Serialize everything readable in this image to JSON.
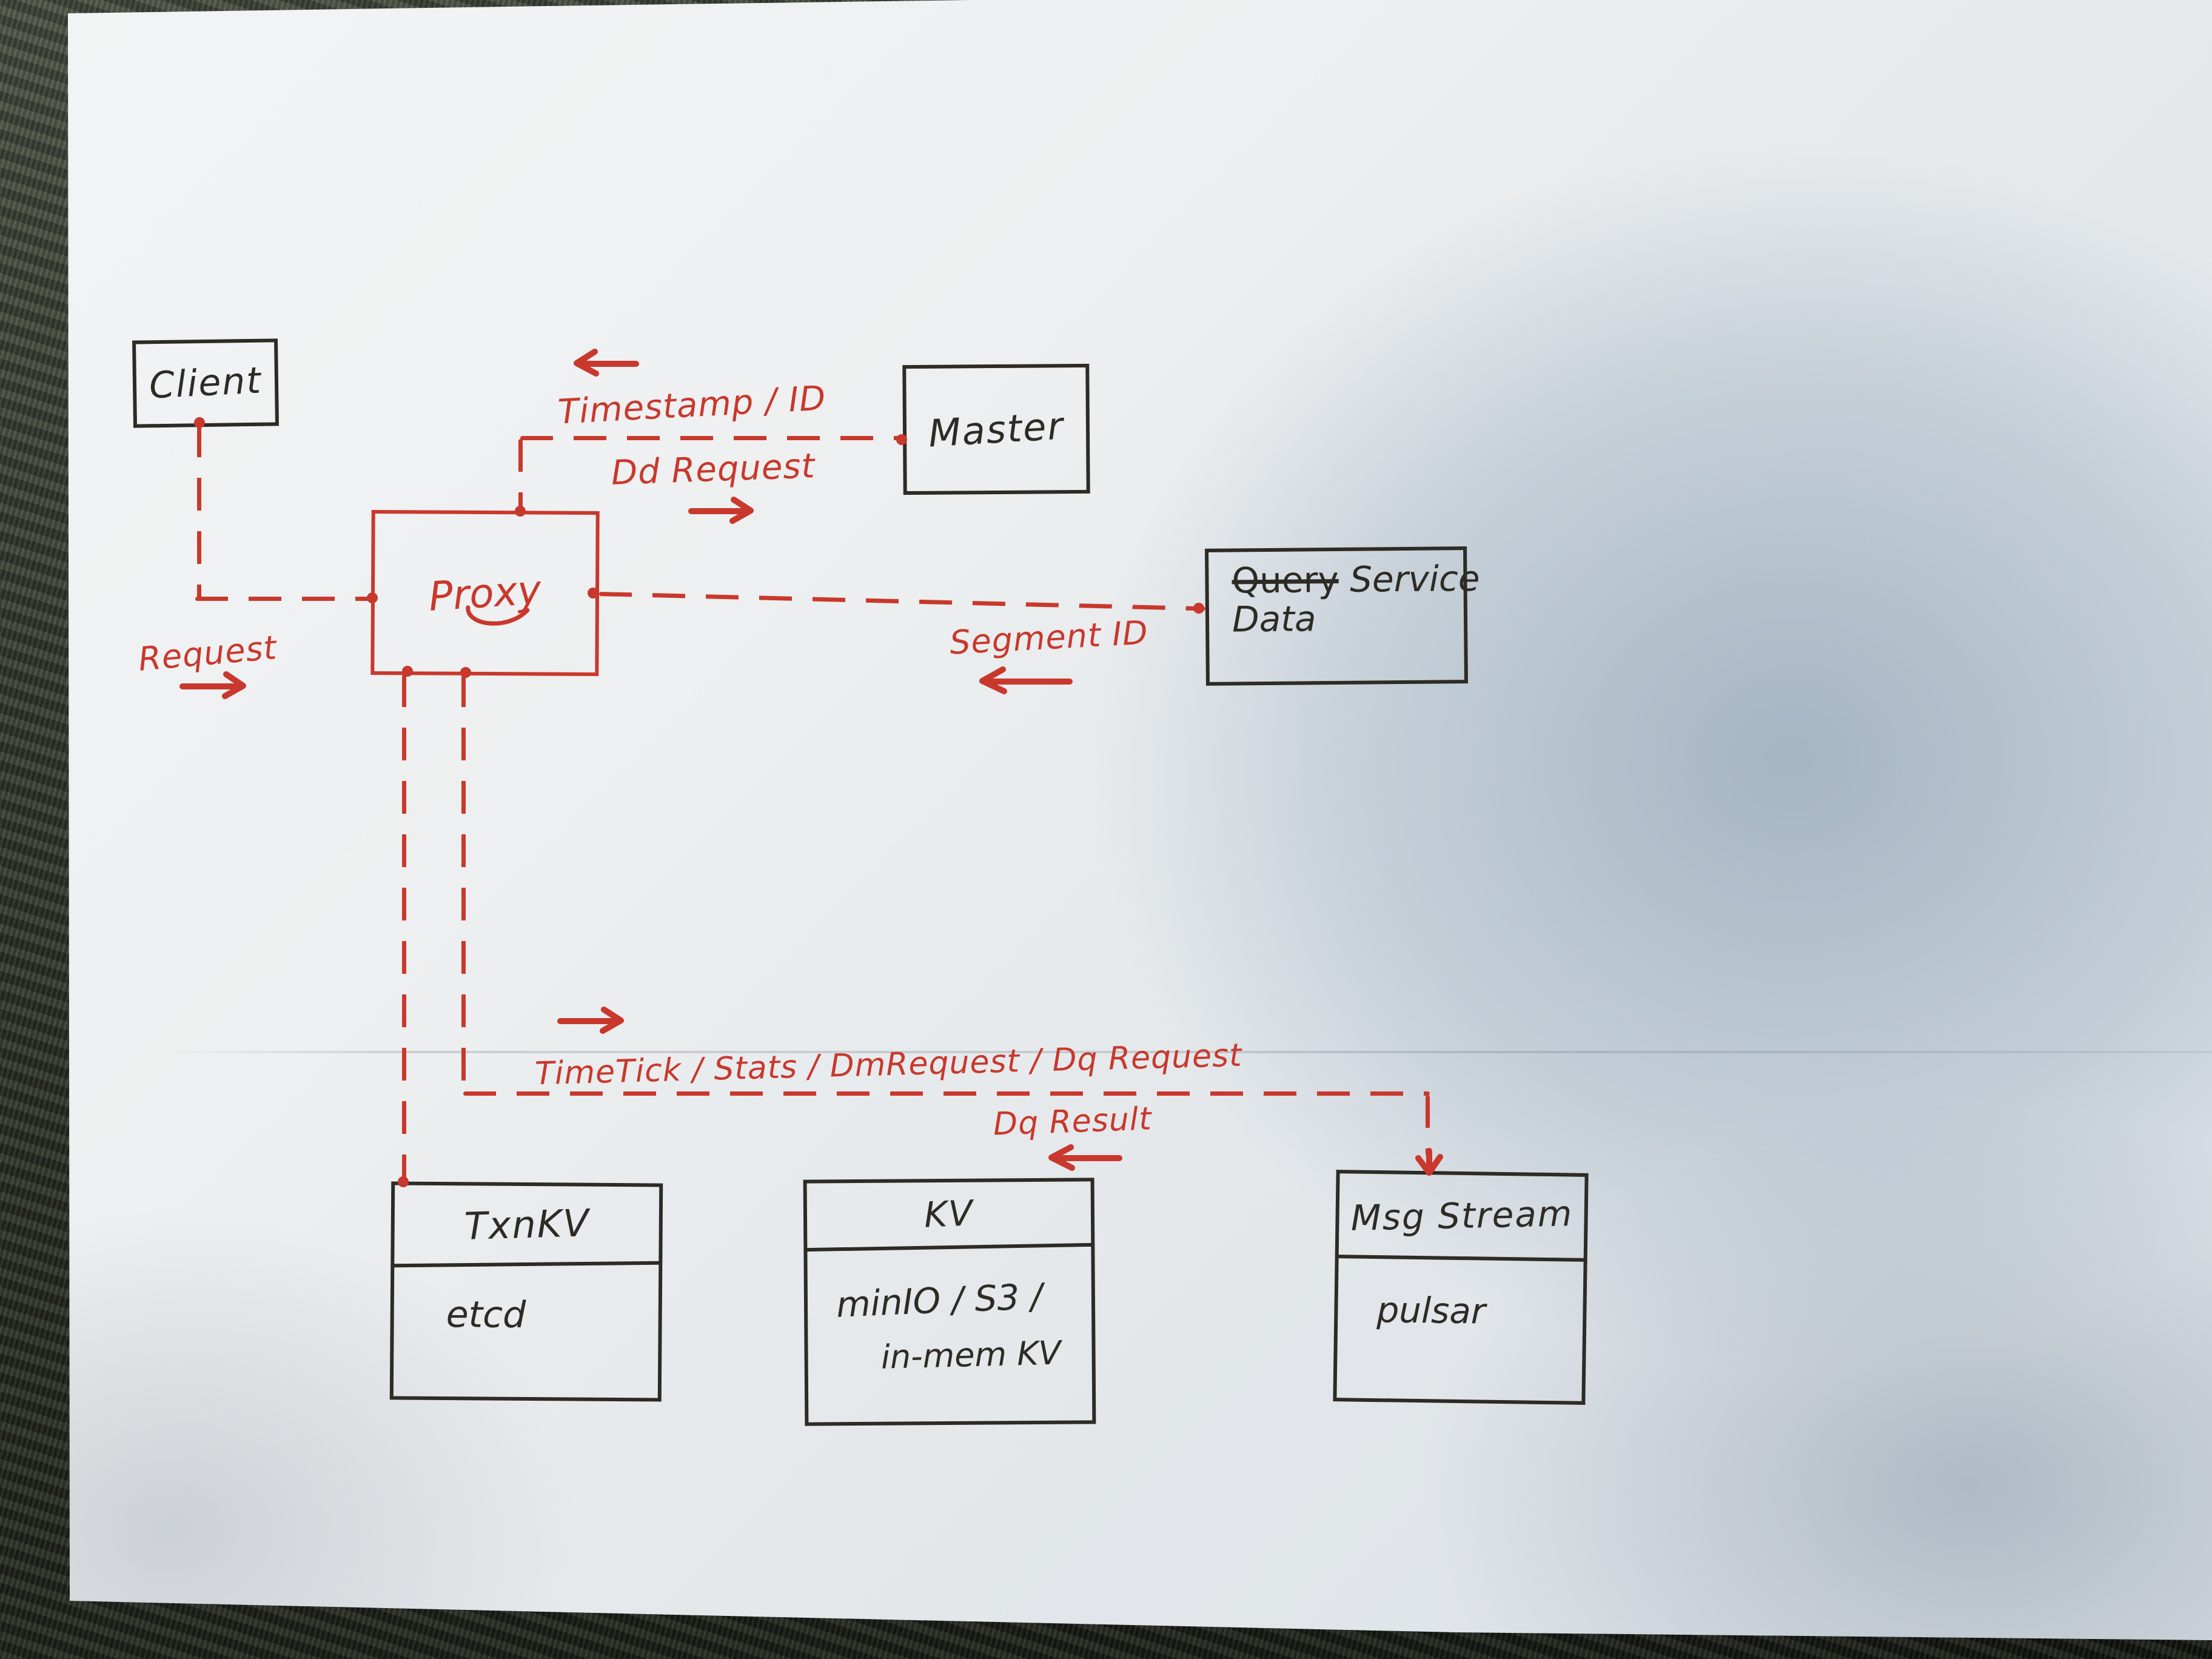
{
  "title": "Hand-drawn system architecture sketch (proxy-based service on paper)",
  "colors": {
    "ink_black": "#2e2b25",
    "ink_red": "#c9382c",
    "paper": "#edeff0",
    "paper_shadow": "#94a7b9",
    "table_background": "#20251d"
  },
  "icons": {
    "arrow-left-icon": "←",
    "arrow-right-icon": "→",
    "arrow-down-icon": "↓",
    "connection-dot": "•"
  },
  "nodes": {
    "client": {
      "label": "Client"
    },
    "proxy": {
      "label": "Proxy"
    },
    "master": {
      "label": "Master"
    },
    "data_service": {
      "struck_word": "Query",
      "word": "Service",
      "line2": "Data"
    },
    "txn_kv": {
      "header": "TxnKV",
      "body": "etcd"
    },
    "kv": {
      "header": "KV",
      "body_line1": "minIO / S3 /",
      "body_line2": "in-mem KV"
    },
    "msg_stream": {
      "header": "Msg Stream",
      "body": "pulsar"
    }
  },
  "edge_labels": {
    "request": "Request",
    "timestamp_id": "Timestamp / ID",
    "dd_request": "Dd Request",
    "segment_id": "Segment ID",
    "proxy_to_storage": "TimeTick / Stats / DmRequest / Dq Request",
    "dq_result": "Dq Result"
  },
  "edges": [
    {
      "from": "client",
      "to": "proxy",
      "label": "Request",
      "direction": "client→proxy",
      "style": "red-dashed"
    },
    {
      "from": "proxy",
      "to": "master",
      "label_up": "Timestamp / ID",
      "label_down": "Dd Request",
      "style": "red-dashed"
    },
    {
      "from": "proxy",
      "to": "data_service",
      "label": "Segment ID",
      "direction": "data_service→proxy",
      "style": "red-dashed"
    },
    {
      "from": "proxy",
      "to": "txn_kv",
      "style": "red-dashed"
    },
    {
      "from": "proxy",
      "to": "msg_stream",
      "label_up": "TimeTick / Stats / DmRequest / Dq Request",
      "label_down": "Dq Result",
      "style": "red-dashed"
    }
  ]
}
